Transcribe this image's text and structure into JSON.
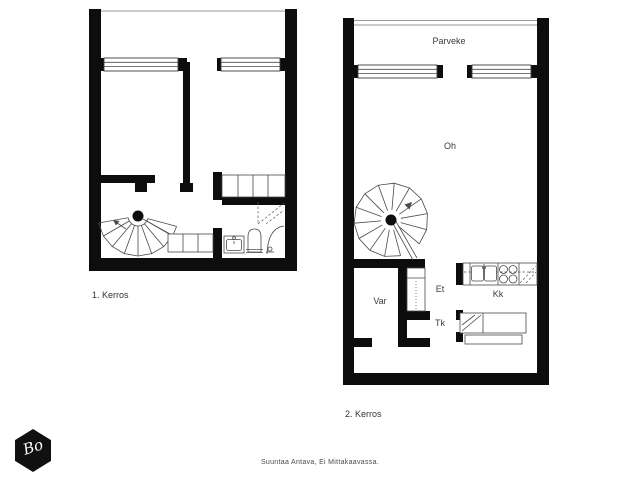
{
  "colors": {
    "background": "#ffffff",
    "wall_ink": "#0d0d0d",
    "line": "#4a4a4a",
    "label_text": "#3c3c3c"
  },
  "floor1": {
    "label": "1. Kerros"
  },
  "floor2": {
    "label": "2. Kerros",
    "room_labels": {
      "balcony": "Parveke",
      "living": "Oh",
      "storage": "Var",
      "hall": "Et",
      "vestibule": "Tk",
      "kitchenette": "Kk"
    }
  },
  "footer": {
    "note": "Suuntaa Antava, Ei Mittakaavassa."
  },
  "logo": {
    "monogram": "Bo"
  }
}
